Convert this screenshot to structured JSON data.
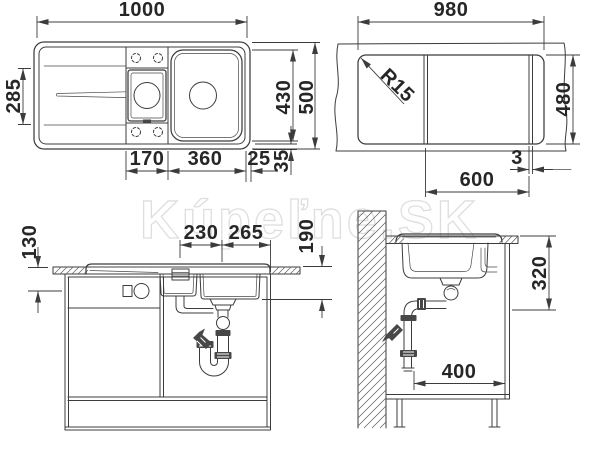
{
  "watermark": {
    "text": "Kúpeľne.SK"
  },
  "colors": {
    "line": "#3c3c3c",
    "text": "#262626",
    "watermark_outline": "#dedede",
    "background": "#ffffff"
  },
  "views": {
    "top": {
      "label": "sink top view",
      "dims": {
        "overall_width": "1000",
        "bowl_opening_height": "285",
        "bowls_span": "430",
        "overall_depth": "500",
        "half_bowl_width": "170",
        "main_bowl_width": "360",
        "rim_right": "25",
        "rim_bottom": "35"
      }
    },
    "cutout": {
      "label": "worktop cutout view",
      "dims": {
        "width": "980",
        "corner_radius": "R15",
        "depth": "480",
        "gap": "3",
        "offset": "600"
      }
    },
    "front": {
      "label": "front installation view",
      "dims": {
        "top_clearance": "130",
        "half_bowl_drain_offset": "230",
        "main_bowl_drain_offset": "265",
        "bowl_depth": "190"
      }
    },
    "section": {
      "label": "side section view",
      "dims": {
        "drain_height": "320",
        "drain_wall_offset": "400"
      }
    }
  }
}
